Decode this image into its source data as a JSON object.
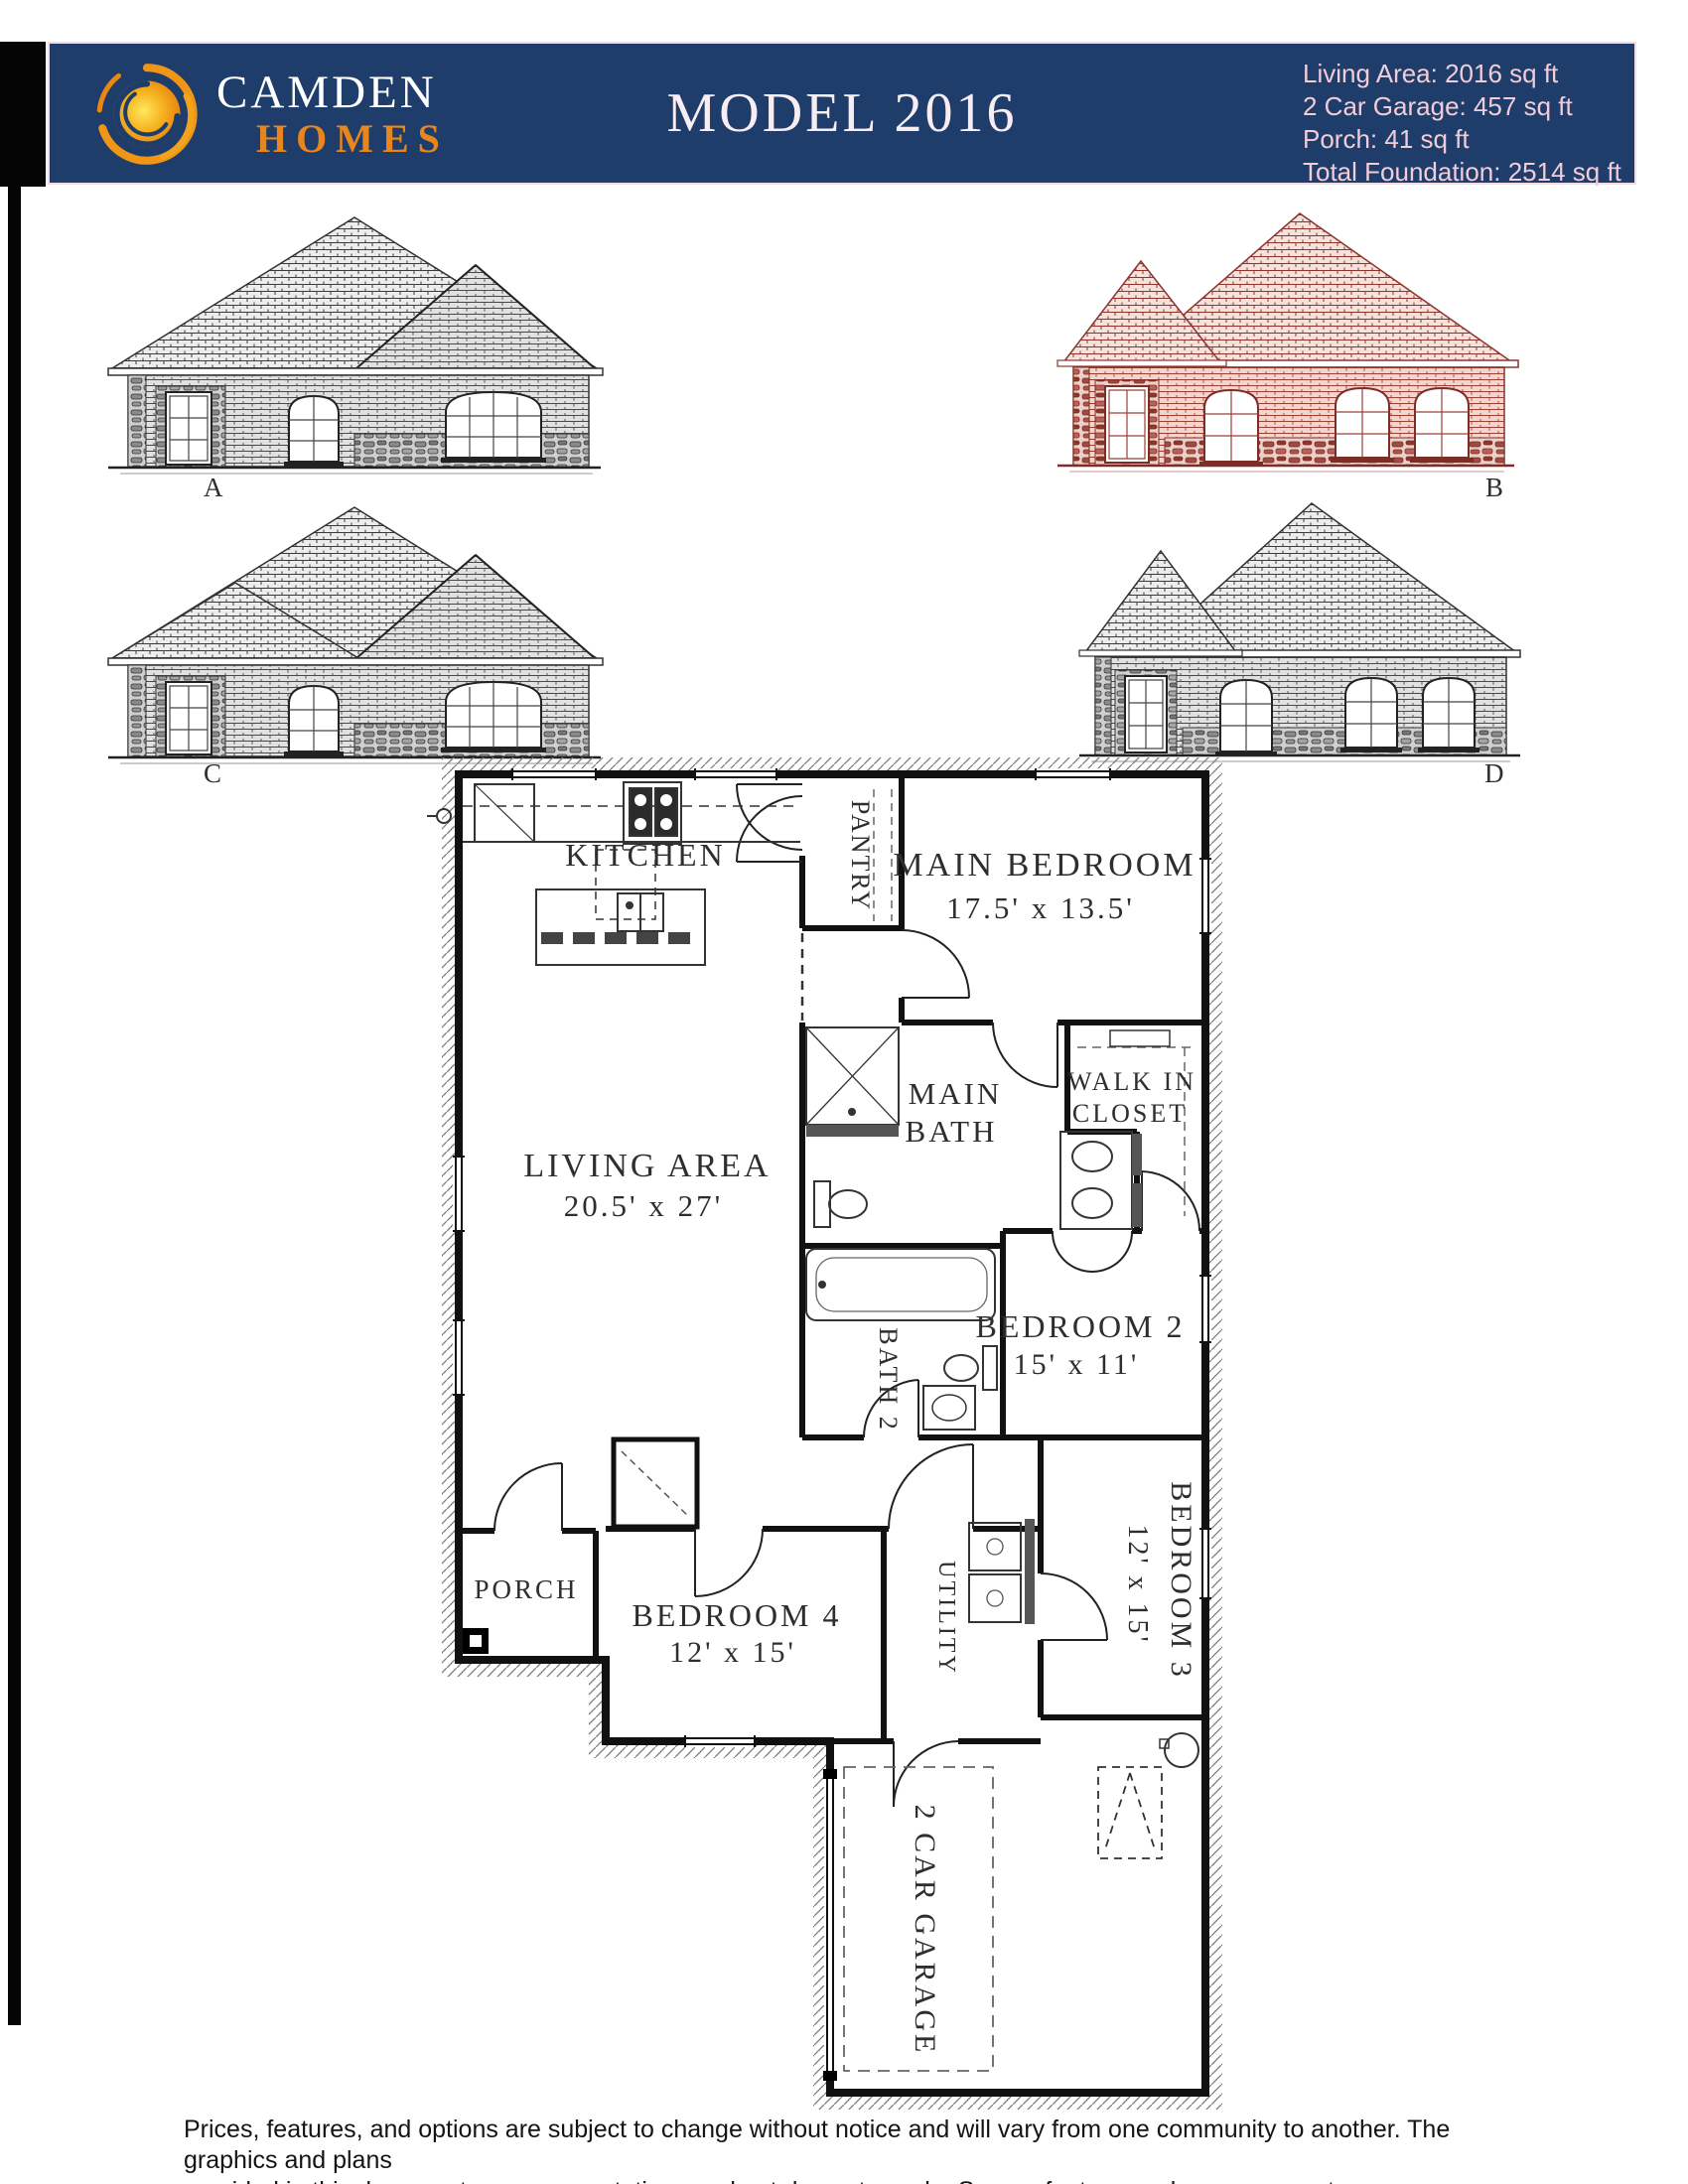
{
  "header": {
    "brand_line1": "CAMDEN",
    "brand_line2": "HOMES",
    "title": "MODEL 2016",
    "stats": [
      "Living Area: 2016 sq ft",
      "2 Car Garage: 457 sq ft",
      "Porch: 41 sq ft",
      "Total Foundation: 2514 sq ft"
    ],
    "colors": {
      "header_bg": "#1e3d6b",
      "brand_primary": "#ffffff",
      "brand_secondary": "#e8851c",
      "stats_text": "#f2ccd6",
      "elevation_red": "#8e352c"
    }
  },
  "elevations": [
    {
      "label": "A"
    },
    {
      "label": "B"
    },
    {
      "label": "C"
    },
    {
      "label": "D"
    }
  ],
  "floor_plan": {
    "kitchen": "KITCHEN",
    "pantry": "PANTRY",
    "main_bedroom": {
      "label": "MAIN BEDROOM",
      "dims": "17.5' x 13.5'"
    },
    "main_bath": {
      "line1": "MAIN",
      "line2": "BATH"
    },
    "walk_in_closet": {
      "line1": "WALK IN",
      "line2": "CLOSET"
    },
    "living_area": {
      "label": "LIVING AREA",
      "dims": "20.5' x 27'"
    },
    "bath2": "BATH 2",
    "bedroom2": {
      "label": "BEDROOM 2",
      "dims": "15' x 11'"
    },
    "porch": "PORCH",
    "bedroom4": {
      "label": "BEDROOM 4",
      "dims": "12' x 15'"
    },
    "utility": "UTILITY",
    "bedroom3": {
      "label": "BEDROOM 3",
      "dims": "12' x 15'"
    },
    "garage": "2 CAR GARAGE"
  },
  "footer": {
    "line1": "Prices, features, and options are subject to change without notice and will vary from one community to another. The graphics and plans",
    "line2": "provided in this document are representations and not drawn to scale. Square footage and measurements are approximate."
  }
}
